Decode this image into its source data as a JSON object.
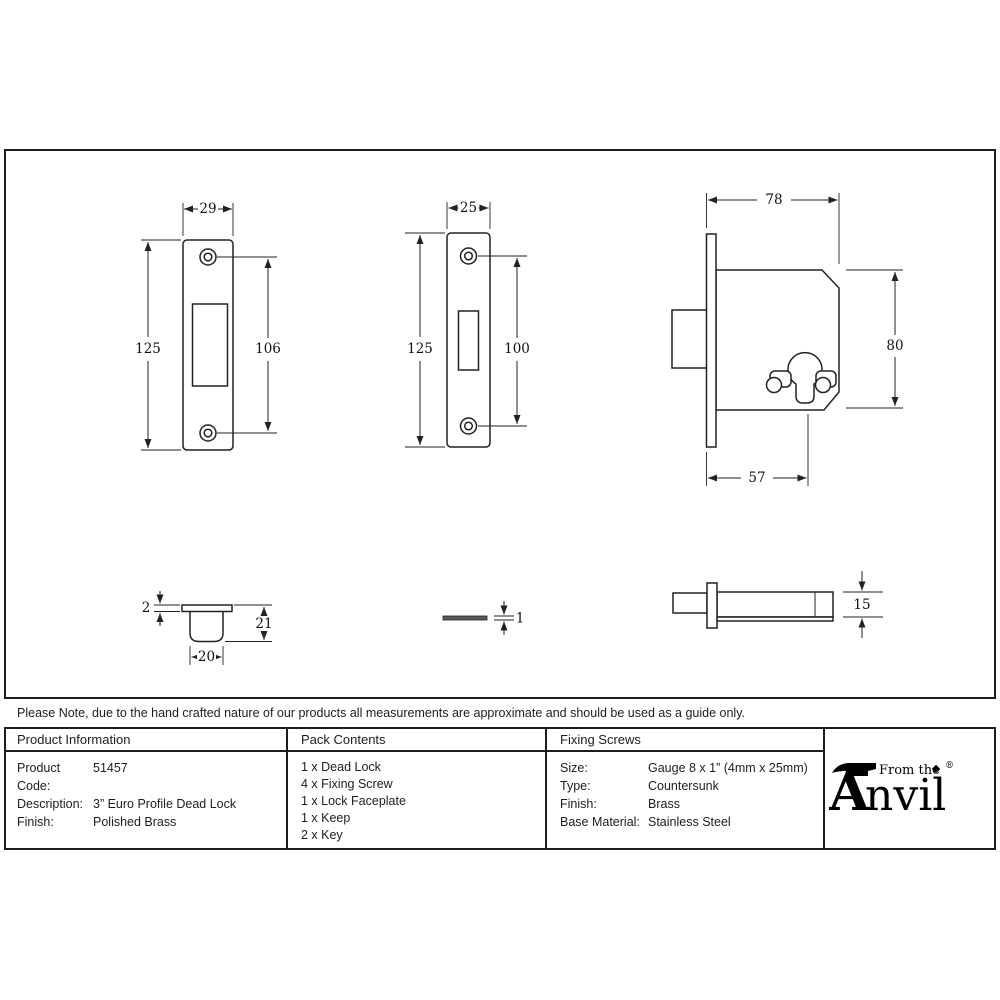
{
  "note": {
    "text": "Please Note, due to the hand crafted nature of our products all measurements are approximate and should be used as a guide only."
  },
  "table": {
    "product_information": {
      "header": "Product Information",
      "rows": [
        {
          "label": "Product Code:",
          "value": "51457"
        },
        {
          "label": "Description:",
          "value": "3” Euro Profile Dead Lock"
        },
        {
          "label": "Finish:",
          "value": "Polished Brass"
        }
      ]
    },
    "pack_contents": {
      "header": "Pack Contents",
      "items": [
        "1 x Dead Lock",
        "4 x Fixing Screw",
        "1 x Lock Faceplate",
        "1 x Keep",
        "2 x Key"
      ]
    },
    "fixing_screws": {
      "header": "Fixing Screws",
      "rows": [
        {
          "label": "Size:",
          "value": "Gauge 8 x 1” (4mm x 25mm)"
        },
        {
          "label": "Type:",
          "value": "Countersunk"
        },
        {
          "label": "Finish:",
          "value": "Brass"
        },
        {
          "label": "Base Material:",
          "value": "Stainless Steel"
        }
      ]
    }
  },
  "logo": {
    "prefix": "From the",
    "initial": "A",
    "rest": "nvil",
    "registered": "®"
  },
  "dimensions": {
    "lock_faceplate_front": {
      "width": "29",
      "height": "125",
      "screw_span": "106"
    },
    "keep_faceplate_front": {
      "width": "25",
      "height": "125",
      "screw_span": "100"
    },
    "lock_case": {
      "width": "78",
      "height": "80",
      "backset": "57"
    },
    "keep_profile": {
      "lip_thickness": "2",
      "depth": "21",
      "width": "20"
    },
    "faceplate_edge": {
      "thickness": "1"
    },
    "lock_case_top": {
      "height": "15"
    }
  },
  "colors": {
    "line": "#1d1d1d",
    "background": "#ffffff"
  }
}
